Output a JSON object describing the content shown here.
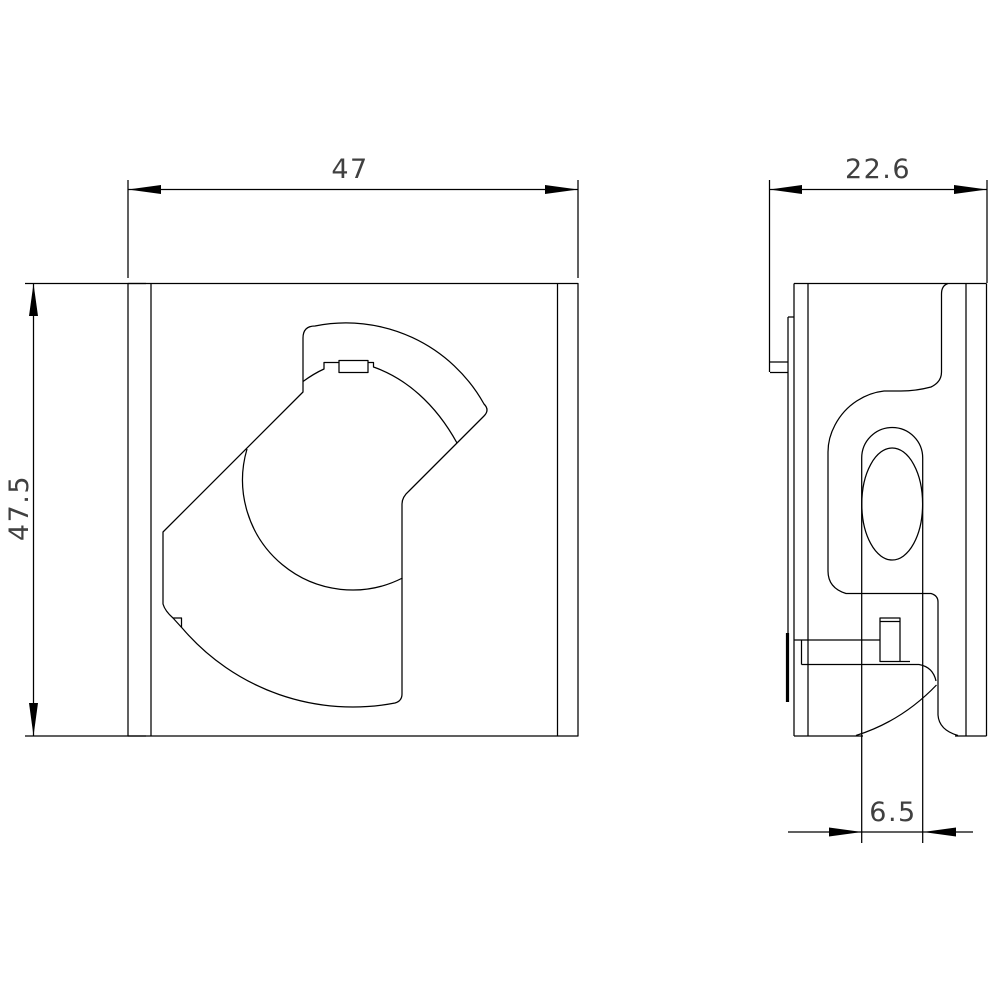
{
  "page": {
    "background": "#ffffff",
    "line_color": "#000000",
    "text_color": "#404040"
  },
  "drawing": {
    "kind": "technical-dimension-drawing",
    "views": [
      {
        "name": "front-view",
        "description": "front view of housing with rotary knob"
      },
      {
        "name": "side-view",
        "description": "side profile with mounting slot"
      }
    ],
    "dimensions": {
      "front_width": "47",
      "front_height": "47.5",
      "side_depth": "22.6",
      "slot_width": "6.5"
    }
  }
}
